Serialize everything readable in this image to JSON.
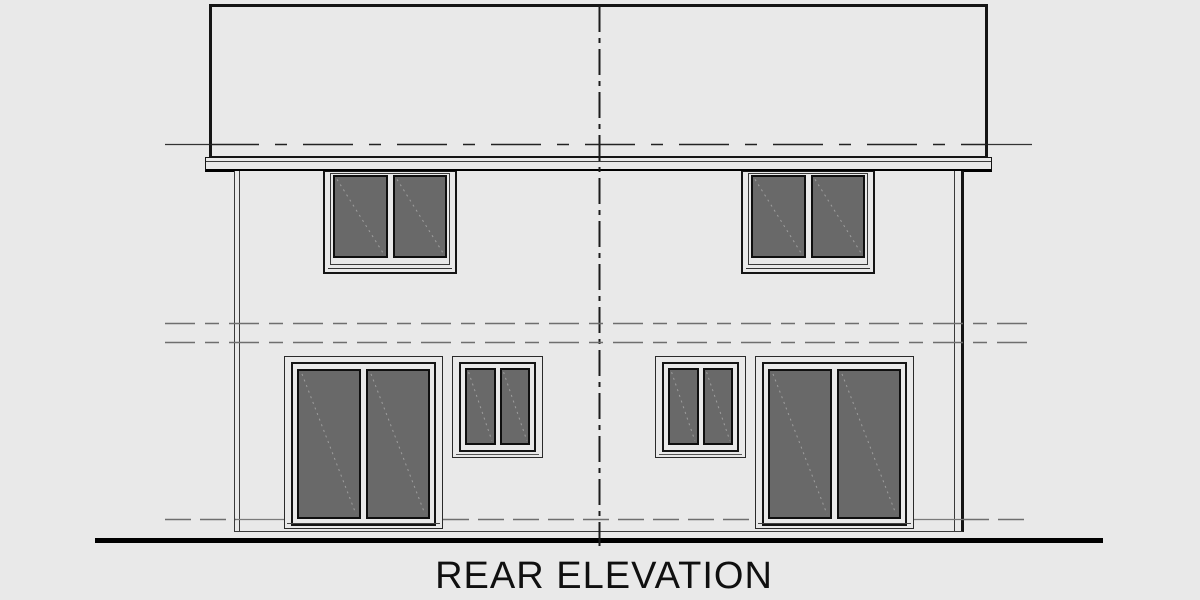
{
  "drawing": {
    "title": "REAR ELEVATION",
    "kind": "duplex house rear elevation line drawing"
  },
  "elements": {
    "roof": "flat gable roof slab with eave overhang",
    "fascia": "eave fascia band",
    "center_line": "vertical dash-dot party wall line",
    "upper_window_count": 2,
    "small_window_count": 2,
    "sliding_door_count": 2,
    "level_line_count": 4,
    "ground_line": "heavy grade line"
  },
  "colors": {
    "background": "#e9e9e9",
    "line": "#151515",
    "line_soft": "#3a3a3a",
    "glass": "#696969",
    "glass_streak": "#9e9e9e",
    "level_line": "#6e6e6e",
    "ground": "#000000"
  }
}
